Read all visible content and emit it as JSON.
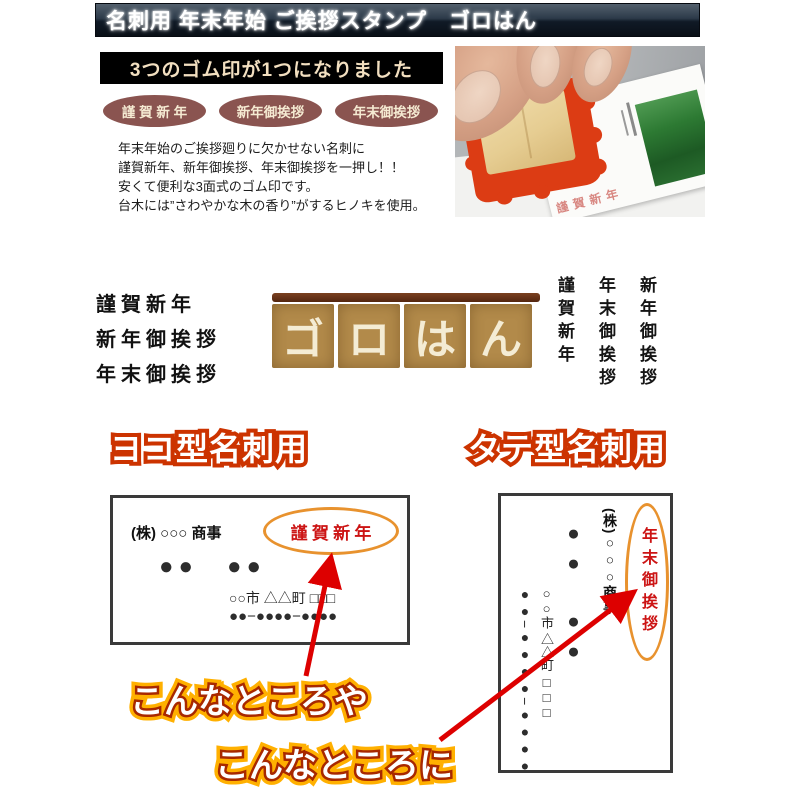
{
  "header": {
    "title": "名刺用 年末年始 ご挨拶スタンプ　ゴロはん"
  },
  "intro": {
    "banner": "3つのゴム印が1つになりました",
    "badges": [
      "謹 賀 新 年",
      "新年御挨拶",
      "年末御挨拶"
    ],
    "description_lines": [
      "年末年始のご挨拶廻りに欠かせない名刺に",
      "謹賀新年、新年御挨拶、年末御挨拶を一押し！！",
      "安くて便利な3面式のゴム印です。",
      "台木には”さわやかな木の香り”がするヒノキを使用。"
    ]
  },
  "photo": {
    "card_stamp_text": "謹賀新年"
  },
  "impressions": {
    "horizontal_lines": [
      "謹 賀 新 年",
      "新 年 御 挨 拶",
      "年 末 御 挨 拶"
    ],
    "logo_chars": [
      "ゴ",
      "ロ",
      "は",
      "ん"
    ],
    "vertical_columns": [
      "謹賀新年",
      "年末御挨拶",
      "新年御挨拶"
    ]
  },
  "sections": {
    "yoko_heading": "ヨコ型名刺用",
    "tate_heading": "タテ型名刺用"
  },
  "yoko_card": {
    "company": "(株) ○○○ 商事",
    "stamp": "謹 賀 新 年",
    "name_dots": "●●　●●",
    "address": "○○市 △△町 □□□",
    "phone": "●●−●●●●−●●●●"
  },
  "tate_card": {
    "company": "(株)○○○商事",
    "stamp": "年末御挨拶",
    "name_dots": "●●　●●",
    "address": "○○市 △△町 □□□",
    "phone": "●●−●●●●−●●●●"
  },
  "annotations": {
    "note1": "こんなところや",
    "note2": "こんなところに"
  },
  "colors": {
    "accent_red": "#cc3300",
    "arrow_red": "#dd0000",
    "oval_orange": "#e8922e",
    "stamp_red": "#cc1414",
    "badge_brown": "#8a5450",
    "badge_text": "#f5ead2",
    "banner_text": "#f2dfc0",
    "noren_tan": "#b28a4a",
    "noren_rod": "#542610",
    "noren_text": "#f4ecd4",
    "note_outer": "#ffb000",
    "note_inner": "#a82800"
  }
}
